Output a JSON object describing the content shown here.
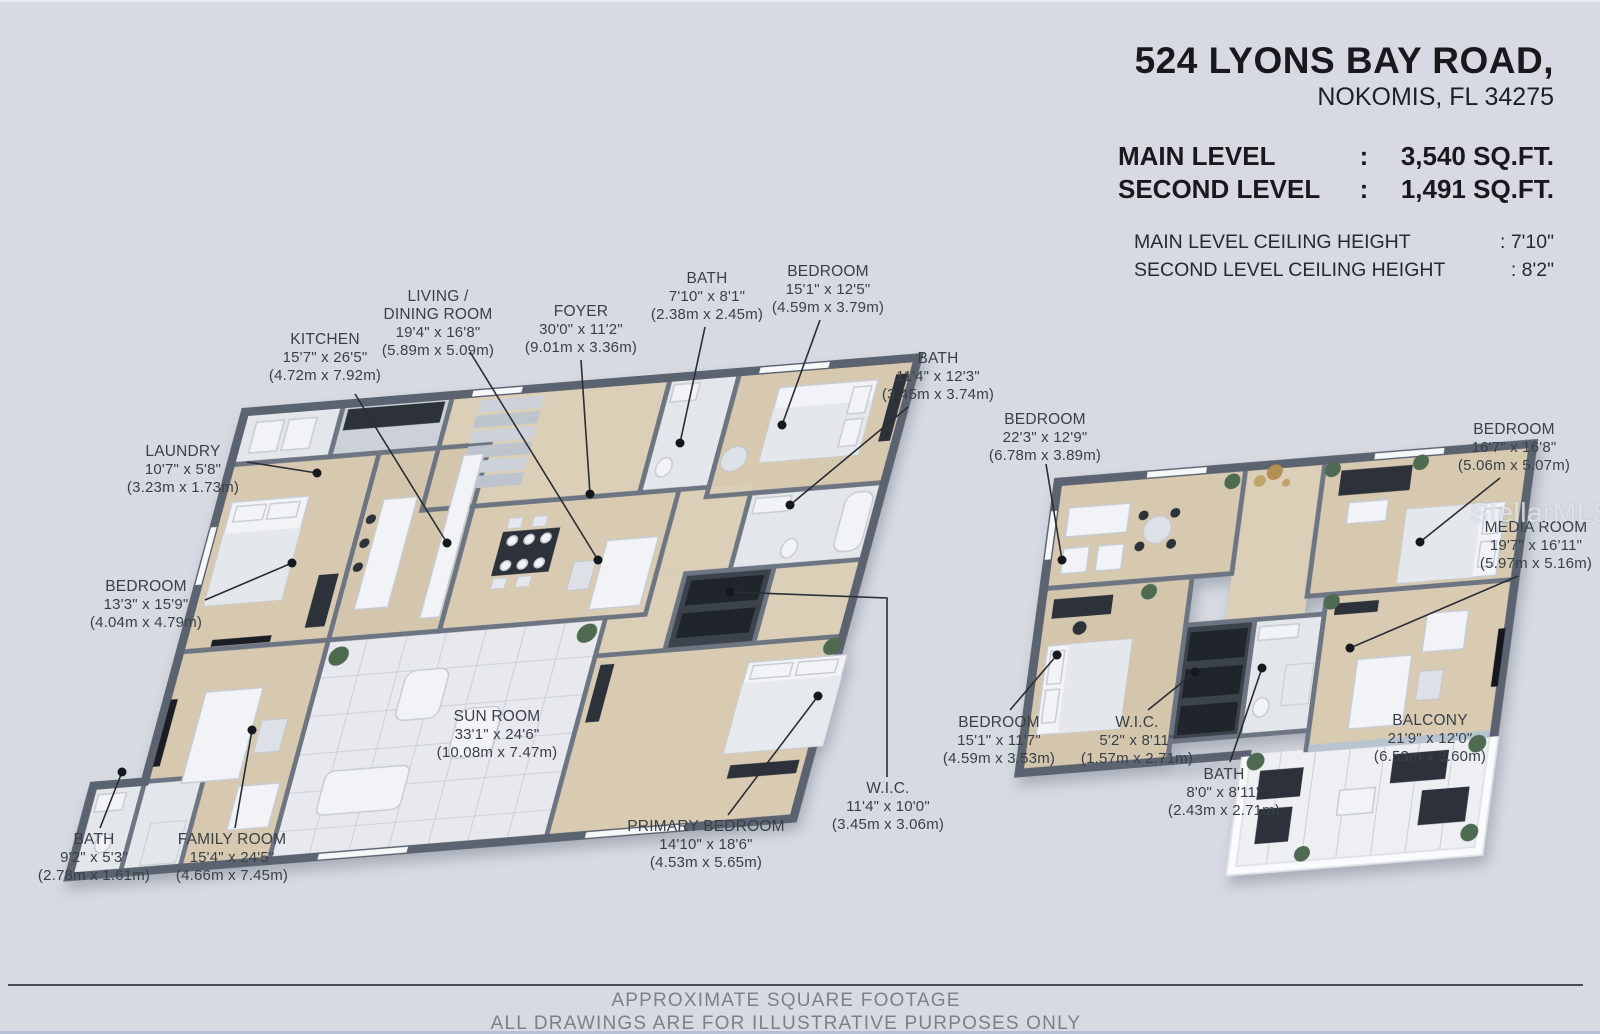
{
  "header": {
    "address_line1": "524 LYONS BAY ROAD,",
    "address_line2": "NOKOMIS, FL 34275",
    "levels": [
      {
        "label": "MAIN LEVEL",
        "colon": ":",
        "value": "3,540 SQ.FT."
      },
      {
        "label": "SECOND LEVEL",
        "colon": ":",
        "value": "1,491 SQ.FT."
      }
    ],
    "ceiling_heights": [
      {
        "label": "MAIN LEVEL CEILING HEIGHT",
        "value": ": 7'10\""
      },
      {
        "label": "SECOND LEVEL CEILING HEIGHT",
        "value": ": 8'2\""
      }
    ]
  },
  "plans": {
    "main": {
      "name": "Main level floor plan",
      "rooms": [
        {
          "name": "KITCHEN",
          "dims_imperial": "15'7\" x 26'5\"",
          "dims_metric": "(4.72m x 7.92m)"
        },
        {
          "name": "LIVING /\nDINING  ROOM",
          "dims_imperial": "19'4\" x 16'8\"",
          "dims_metric": "(5.89m x 5.09m)"
        },
        {
          "name": "FOYER",
          "dims_imperial": "30'0\" x 11'2\"",
          "dims_metric": "(9.01m x 3.36m)"
        },
        {
          "name": "BATH",
          "dims_imperial": "7'10\" x 8'1\"",
          "dims_metric": "(2.38m x 2.45m)"
        },
        {
          "name": "BEDROOM",
          "dims_imperial": "15'1\" x 12'5\"",
          "dims_metric": "(4.59m x 3.79m)"
        },
        {
          "name": "BATH",
          "dims_imperial": "11'4\" x 12'3\"",
          "dims_metric": "(3.45m x 3.74m)"
        },
        {
          "name": "LAUNDRY",
          "dims_imperial": "10'7\" x 5'8\"",
          "dims_metric": "(3.23m x 1.73m)"
        },
        {
          "name": "BEDROOM",
          "dims_imperial": "13'3\" x 15'9\"",
          "dims_metric": "(4.04m x 4.79m)"
        },
        {
          "name": "SUN ROOM",
          "dims_imperial": "33'1\" x 24'6\"",
          "dims_metric": "(10.08m x 7.47m)"
        },
        {
          "name": "BATH",
          "dims_imperial": "9'2\" x 5'3\"",
          "dims_metric": "(2.78m x 1.61m)"
        },
        {
          "name": "FAMILY ROOM",
          "dims_imperial": "15'4\" x 24'5\"",
          "dims_metric": "(4.66m x 7.45m)"
        },
        {
          "name": "PRIMARY BEDROOM",
          "dims_imperial": "14'10\" x 18'6\"",
          "dims_metric": "(4.53m x 5.65m)"
        },
        {
          "name": "W.I.C.",
          "dims_imperial": "11'4\" x 10'0\"",
          "dims_metric": "(3.45m x 3.06m)"
        }
      ]
    },
    "second": {
      "name": "Second level floor plan",
      "rooms": [
        {
          "name": "BEDROOM",
          "dims_imperial": "22'3\" x 12'9\"",
          "dims_metric": "(6.78m x 3.89m)"
        },
        {
          "name": "BEDROOM",
          "dims_imperial": "16'7\" x 16'8\"",
          "dims_metric": "(5.06m x 5.07m)"
        },
        {
          "name": "MEDIA ROOM",
          "dims_imperial": "19'7\" x 16'11\"",
          "dims_metric": "(5.97m x 5.16m)"
        },
        {
          "name": "BEDROOM",
          "dims_imperial": "15'1\" x 11'7\"",
          "dims_metric": "(4.59m x 3.53m)"
        },
        {
          "name": "W.I.C.",
          "dims_imperial": "5'2\" x 8'11\"",
          "dims_metric": "(1.57m x 2.71m)"
        },
        {
          "name": "BATH",
          "dims_imperial": "8'0\" x 8'11\"",
          "dims_metric": "(2.43m x 2.71m)"
        },
        {
          "name": "BALCONY",
          "dims_imperial": "21'9\" x 12'0\"",
          "dims_metric": "(6.53m x 3.60m)"
        }
      ]
    }
  },
  "watermark": "StellarMLS",
  "footer": {
    "line1": "APPROXIMATE SQUARE FOOTAGE",
    "line2": "ALL DRAWINGS ARE FOR ILLUSTRATIVE PURPOSES ONLY"
  },
  "palette": {
    "background": "#d7dae2",
    "wall": "#6e7582",
    "wall_outer": "#5c6370",
    "floor_wood": "#d7c9b0",
    "floor_tile": "#e7e9ee",
    "label_text": "#3a4047",
    "dark_furniture": "#2d323a",
    "divider": "#474d57"
  }
}
